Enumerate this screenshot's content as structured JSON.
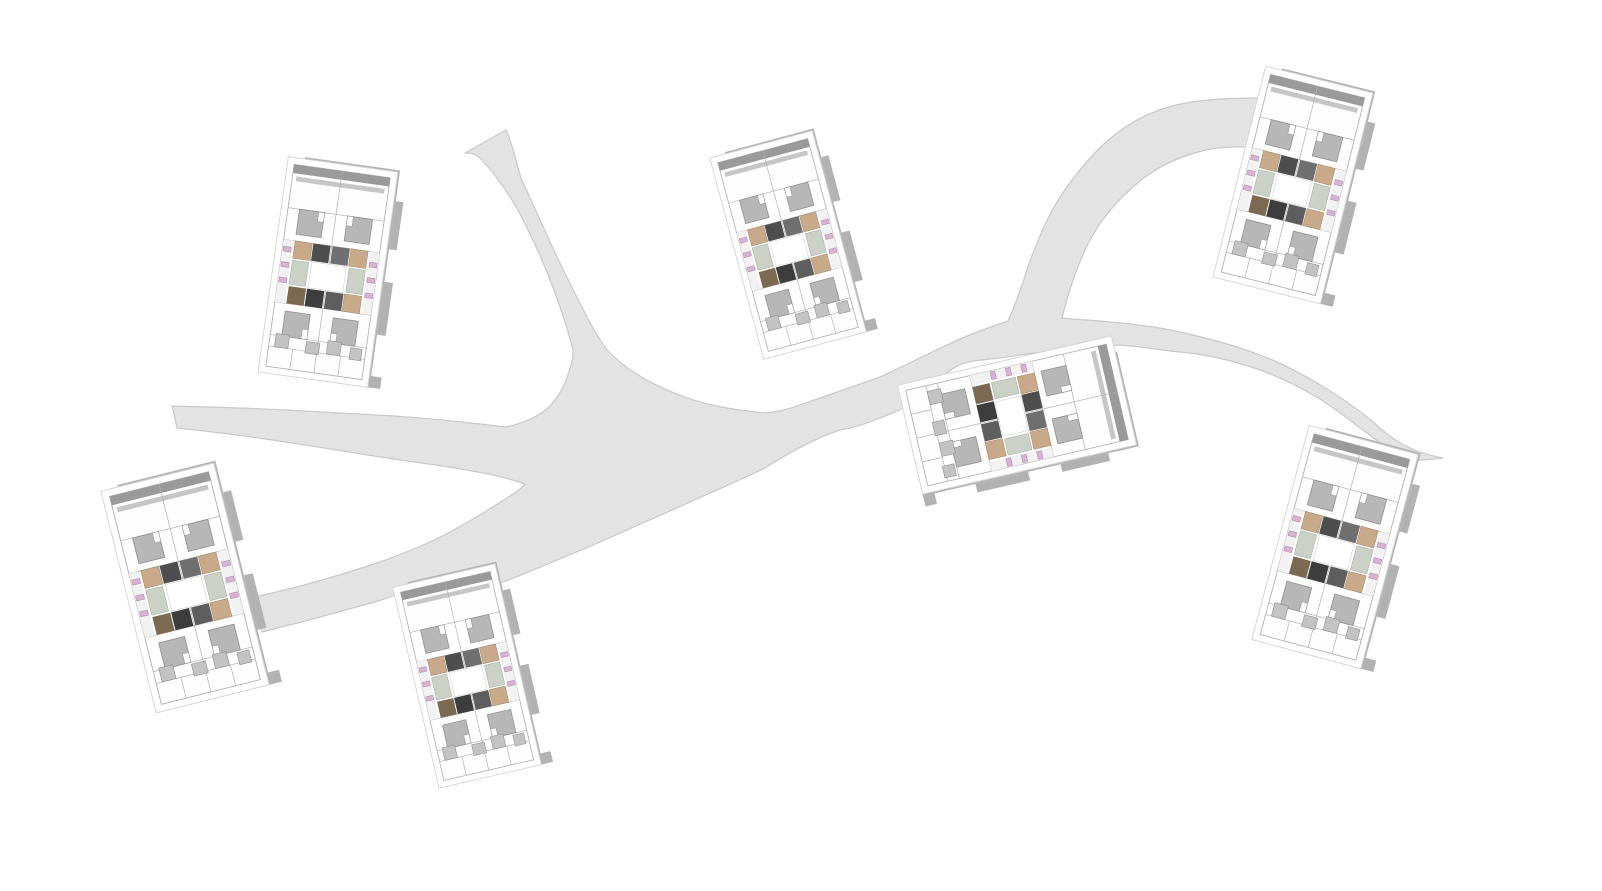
{
  "scene": {
    "description": "Axonometric architectural site plan: seven identical modular housing blocks placed along an organic branching pedestrian path network on a white ground plane.",
    "canvas": {
      "width": 1602,
      "height": 891,
      "background": "#ffffff"
    },
    "palette": {
      "path_fill": "#e3e3e4",
      "path_edge": "#c9c9c9",
      "shadow": "#b2b2b2",
      "plot_line": "#d6d6d6",
      "building_line": "#b0b0b0",
      "roof_white": "#fefefe",
      "roof_band_dark": "#9a9a9a",
      "roof_band_light": "#c6c6c6",
      "courtyard_gray": "#b7b7b7",
      "courtyard_line": "#8e8e8e",
      "balcony_gray": "#c3c3c3",
      "deck_tan": "#c8a98a",
      "deck_tan_line": "#a08766",
      "deck_brown": "#7c6952",
      "core_dark_a": "#4e4e4e",
      "core_dark_b": "#6f6f6f",
      "core_dark_c": "#3d3d3d",
      "core_dark_d": "#5e5e5e",
      "patio_green": "#cbd1c7",
      "patio_green_line": "#a3a99f",
      "furniture_pink": "#d8b2d2",
      "furniture_pink_line": "#b085aa",
      "inner_court_line": "#c9c9c9"
    },
    "path_network": {
      "label": "branching pedestrian path",
      "endpoints": [
        "top edge",
        "west terminus",
        "south-west block",
        "north-east block",
        "east block"
      ],
      "outline": "M 506 130 C 514 148 516 162 521 178 C 532 202 540 220 551 244 C 562 268 572 288 584 311 C 591 325 598 338 608 351 C 628 372 660 390 700 402 C 722 408 744 411 765 413 C 784 412 802 404 820 398 C 840 391 860 384 880 377 C 897 369 914 361 930 353 C 947 345 963 337 980 331 C 990 327 999 324 1008 321 C 1020 295 1026 270 1035 248 C 1046 220 1056 201 1072 180 C 1084 164 1096 150 1112 137 C 1130 122 1152 111 1176 105 C 1202 99 1230 98 1258 98 L 1262 148 C 1240 146 1218 146 1198 152 C 1176 158 1156 168 1140 181 C 1118 199 1100 220 1088 244 C 1076 268 1068 294 1062 318 C 1078 320 1094 320 1110 322 C 1134 324 1158 327 1180 332 C 1207 338 1234 345 1260 355 C 1282 363 1302 374 1322 386 C 1342 398 1362 412 1380 428 C 1396 442 1412 452 1443 458 L 1402 462 C 1388 448 1374 438 1360 428 C 1342 414 1326 402 1308 392 C 1288 381 1268 372 1248 366 C 1226 359 1202 354 1180 352 C 1158 350 1138 346 1120 345 C 1100 346 1080 348 1060 350 C 1040 352 1020 355 1000 358 C 985 360 972 360 962 364 C 950 368 936 382 920 398 C 906 408 893 413 880 418 C 866 424 852 428 840 430 C 815 438 790 452 765 468 C 736 482 712 492 690 502 C 664 514 640 524 618 534 C 594 545 572 554 550 563 C 526 573 504 583 480 589 C 462 594 444 596 430 595 C 420 594 408 592 398 594 C 388 598 376 602 364 605 C 340 611 312 620 285 626 C 277 628 270 630 262 632 L 250 598 C 268 594 286 590 304 585 C 330 578 356 570 380 562 C 404 553 428 544 450 532 C 474 519 498 504 516 492 C 520 489 523 487 525 484 C 508 478 490 474 472 471 C 446 466 420 463 394 459 C 360 454 326 448 292 443 C 254 437 215 432 177 428 L 172 406 C 210 407 248 408 286 410 C 322 412 358 414 394 416 C 420 418 448 420 470 423 C 483 424 496 426 505 427 C 522 424 538 417 549 407 C 560 396 566 383 570 368 C 573 360 573 355 573 350 C 568 330 562 312 554 290 C 545 266 536 246 526 226 C 514 200 498 178 482 160 C 476 153 470 153 465 153 Z"
    },
    "buildings": [
      {
        "id": "building-1",
        "label": "housing block north-west",
        "cx": 328,
        "cy": 272,
        "rotation": 8,
        "scale": 0.97
      },
      {
        "id": "building-2",
        "label": "housing block north-center",
        "cx": 788,
        "cy": 245,
        "rotation": -15,
        "scale": 0.93
      },
      {
        "id": "building-3",
        "label": "housing block north-east",
        "cx": 1293,
        "cy": 185,
        "rotation": 14,
        "scale": 0.97
      },
      {
        "id": "building-4",
        "label": "housing block center (landscape)",
        "cx": 1017,
        "cy": 415,
        "rotation": 77,
        "scale": 0.98
      },
      {
        "id": "building-5",
        "label": "housing block east",
        "cx": 1335,
        "cy": 547,
        "rotation": 15,
        "scale": 0.99
      },
      {
        "id": "building-6",
        "label": "housing block south-west",
        "cx": 185,
        "cy": 588,
        "rotation": -14,
        "scale": 1.02
      },
      {
        "id": "building-7",
        "label": "housing block south-center",
        "cx": 467,
        "cy": 676,
        "rotation": -13,
        "scale": 0.92
      }
    ]
  }
}
